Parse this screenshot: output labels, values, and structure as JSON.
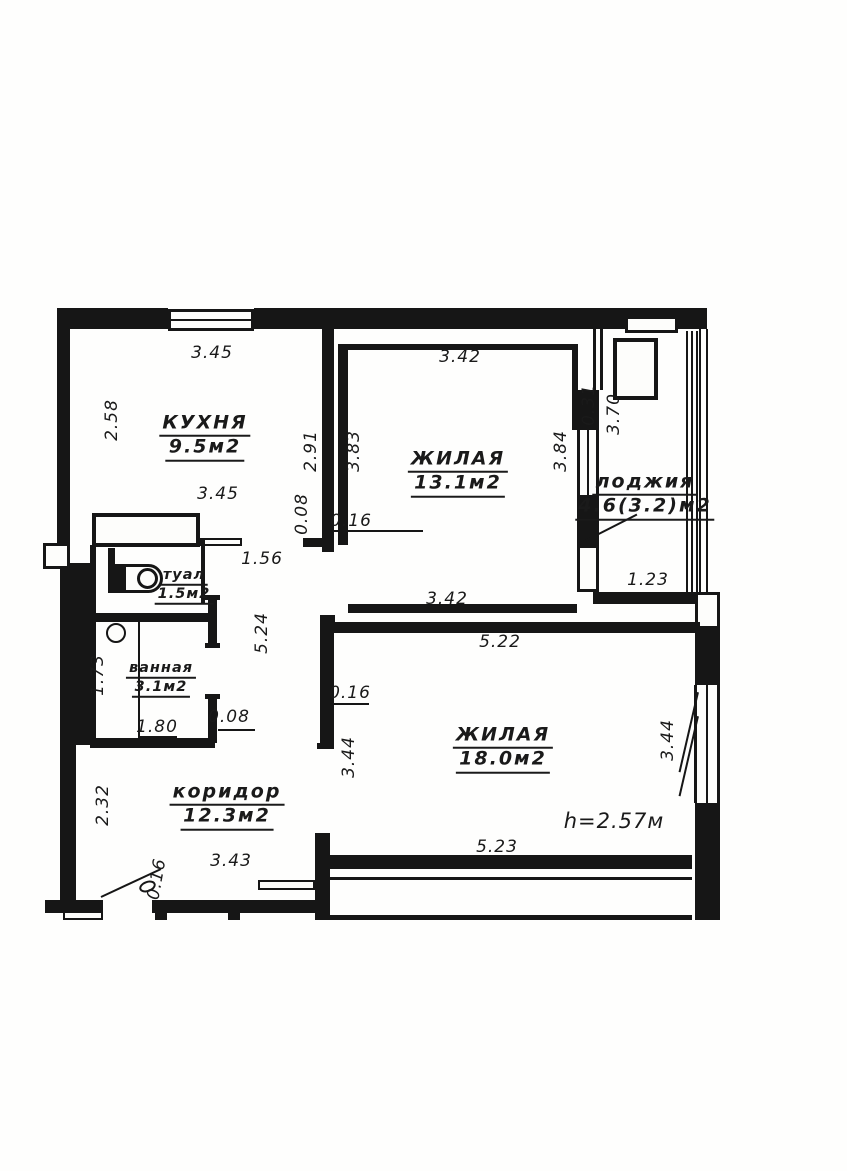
{
  "floor_plan": {
    "ink_color": "#161616",
    "paper_color": "#fefefd",
    "rooms": [
      {
        "key": "kitchen",
        "name": "КУХНЯ",
        "area": "9.5м2",
        "x": 205,
        "y": 437,
        "size": "large"
      },
      {
        "key": "living-room-1",
        "name": "ЖИЛАЯ",
        "area": "13.1м2",
        "x": 458,
        "y": 473,
        "size": "large"
      },
      {
        "key": "loggia",
        "name": "лоджия",
        "area": "4.6(3.2)м2",
        "x": 645,
        "y": 496,
        "size": "large"
      },
      {
        "key": "toilet",
        "name": "туал",
        "area": "1.5м2",
        "x": 184,
        "y": 586,
        "size": "small"
      },
      {
        "key": "bathroom",
        "name": "ванная",
        "area": "3.1м2",
        "x": 161,
        "y": 679,
        "size": "small"
      },
      {
        "key": "living-room-2",
        "name": "ЖИЛАЯ",
        "area": "18.0м2",
        "x": 503,
        "y": 749,
        "size": "large"
      },
      {
        "key": "corridor",
        "name": "коридор",
        "area": "12.3м2",
        "x": 227,
        "y": 806,
        "size": "large"
      }
    ],
    "dimensions": [
      {
        "text": "3.45",
        "x": 212,
        "y": 353,
        "rot": 0
      },
      {
        "text": "2.58",
        "x": 112,
        "y": 420,
        "rot": -90
      },
      {
        "text": "3.45",
        "x": 218,
        "y": 494,
        "rot": 0
      },
      {
        "text": "2.91",
        "x": 311,
        "y": 451,
        "rot": -90
      },
      {
        "text": "0.08",
        "x": 302,
        "y": 514,
        "rot": -90
      },
      {
        "text": "0.16",
        "x": 351,
        "y": 521,
        "rot": 0
      },
      {
        "text": "3.42",
        "x": 460,
        "y": 357,
        "rot": 0
      },
      {
        "text": "3.83",
        "x": 354,
        "y": 451,
        "rot": -90
      },
      {
        "text": "3.84",
        "x": 561,
        "y": 451,
        "rot": -90
      },
      {
        "text": "0.31",
        "x": 589,
        "y": 405,
        "rot": -90
      },
      {
        "text": "3.70",
        "x": 614,
        "y": 414,
        "rot": -90
      },
      {
        "text": "1.56",
        "x": 262,
        "y": 559,
        "rot": 0
      },
      {
        "text": "5.24",
        "x": 262,
        "y": 633,
        "rot": -90
      },
      {
        "text": "1.23",
        "x": 648,
        "y": 580,
        "rot": 0
      },
      {
        "text": "3.42",
        "x": 447,
        "y": 599,
        "rot": 0
      },
      {
        "text": "5.22",
        "x": 500,
        "y": 642,
        "rot": 0
      },
      {
        "text": "0.16",
        "x": 350,
        "y": 693,
        "rot": 0
      },
      {
        "text": "3.44",
        "x": 349,
        "y": 757,
        "rot": -90
      },
      {
        "text": "3.44",
        "x": 668,
        "y": 740,
        "rot": -90
      },
      {
        "text": "5.23",
        "x": 497,
        "y": 847,
        "rot": 0
      },
      {
        "text": "2.32",
        "x": 103,
        "y": 805,
        "rot": -90
      },
      {
        "text": "3.43",
        "x": 231,
        "y": 861,
        "rot": 0
      },
      {
        "text": "0.16",
        "x": 157,
        "y": 879,
        "rot": -80
      },
      {
        "text": "1.73",
        "x": 98,
        "y": 675,
        "rot": -90
      },
      {
        "text": "1.80",
        "x": 157,
        "y": 727,
        "rot": 0
      },
      {
        "text": "0.08",
        "x": 229,
        "y": 717,
        "rot": 0
      }
    ],
    "annotations": [
      {
        "text": "h=2.57м",
        "x": 614,
        "y": 821
      }
    ]
  }
}
